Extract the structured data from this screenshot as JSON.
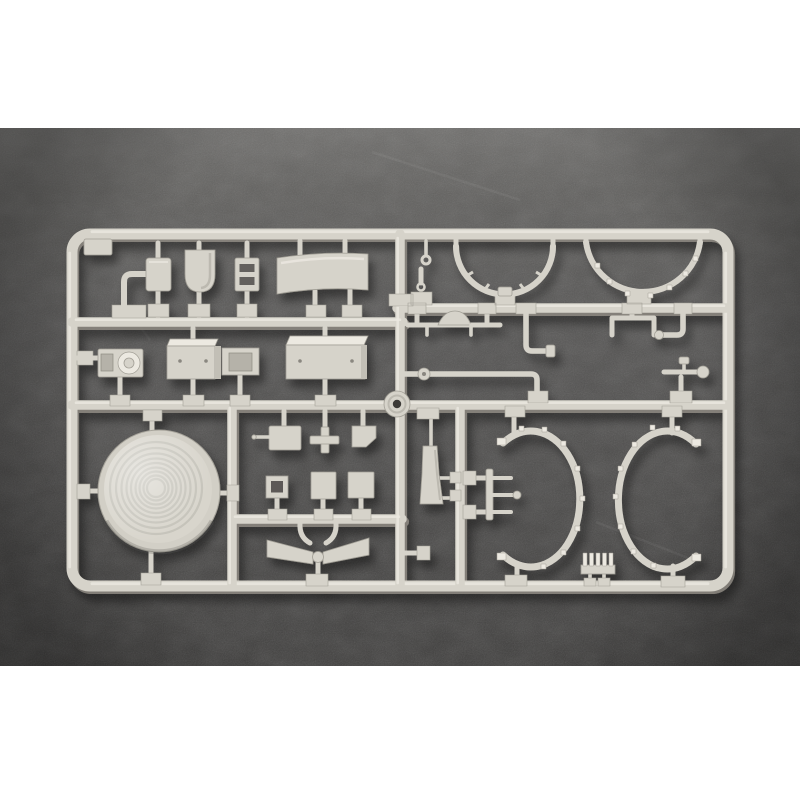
{
  "scene": {
    "kind": "photograph",
    "subject": "Injection-molded model kit sprue (light grey styrene parts tree) on a dark speckled surface",
    "description": "A rectangular light-grey plastic sprue frame holds unassembled scale-model parts: small fittings, a tank, a ladder bracket and a wide curved canvas panel in the top row; a winch and three riveted equipment boxes plus axles, elbow pipes and brackets in the middle row; a large ribbed circular dome, small hatches, bowtie wings, a rudder blade, a trident bracket, two open C-shaped half rings and a comb grate in the bottom row. The photo sits between plain white bands at the top and bottom of the image.",
    "visible_text": "",
    "part_count_approx": 40
  },
  "photo": {
    "band_top_px": 128,
    "band_bottom_px": 666,
    "surface": "dark grey speckled stone/felt, lighter toward the top, vignetted corners"
  },
  "colors": {
    "letterbox": "#ffffff",
    "bg_top": "#6f6e6c",
    "bg_mid": "#525150",
    "bg_bottom": "#3e3d3c",
    "plastic": "#d6d3ca",
    "plastic_light": "#ece9e1",
    "plastic_mid": "#c2bfb6",
    "plastic_dark": "#a29f96",
    "plastic_deep": "#8e8b82",
    "hole": "#3c3b38",
    "recess": "#b5b2a9",
    "rivet": "#8a8780"
  },
  "sprue": {
    "material": "light grey styrene",
    "frame": "rounded rectangle with two horizontal internal rails and three vertical rails",
    "parts": [
      {
        "name": "corner-tab",
        "desc": "small tab at top-left corner"
      },
      {
        "name": "hook-pipe",
        "desc": "candy-cane shaped pipe"
      },
      {
        "name": "small-box",
        "desc": "small rounded box"
      },
      {
        "name": "fuel-tank",
        "desc": "rounded-bottom tank"
      },
      {
        "name": "ladder-bracket",
        "desc": "plate with two slots"
      },
      {
        "name": "curved-panel",
        "desc": "wide slightly curved canvas panel"
      },
      {
        "name": "eyelet-pins",
        "desc": "two tiny pins with eye rings"
      },
      {
        "name": "tilt-frame-arc-left",
        "desc": "smooth semicircular bow"
      },
      {
        "name": "tilt-frame-arc-right",
        "desc": "studded semicircular bow"
      },
      {
        "name": "axle-with-hump",
        "desc": "rod with raised center"
      },
      {
        "name": "z-pipe",
        "desc": "down-and-right elbow pipe"
      },
      {
        "name": "staple-bracket",
        "desc": "U shaped bracket"
      },
      {
        "name": "elbow-pipe-ball",
        "desc": "elbow pipe with ball end"
      },
      {
        "name": "long-pipe-collar",
        "desc": "long pipe with collar and down elbow"
      },
      {
        "name": "lever-ball",
        "desc": "lever arm with ball end"
      },
      {
        "name": "winch",
        "desc": "box with round cable drum"
      },
      {
        "name": "equipment-box-1",
        "desc": "box with two rivets"
      },
      {
        "name": "equipment-box-2",
        "desc": "box with recessed door"
      },
      {
        "name": "equipment-box-3",
        "desc": "wide box with two rivets"
      },
      {
        "name": "grommet-ring",
        "desc": "small donut ring with center hole"
      },
      {
        "name": "ribbed-dome-disc",
        "desc": "large circular dome with concentric ribs"
      },
      {
        "name": "box-with-pin",
        "desc": "small box with side pin"
      },
      {
        "name": "cross-piece",
        "desc": "plus shaped fitting"
      },
      {
        "name": "angled-plate",
        "desc": "small notched plate"
      },
      {
        "name": "frame-square-open",
        "desc": "small open square frame"
      },
      {
        "name": "hatch-square-small",
        "desc": "small square hatch"
      },
      {
        "name": "hatch-square-large",
        "desc": "square hatch"
      },
      {
        "name": "bowtie-wings",
        "desc": "two outward wings meeting at a hub"
      },
      {
        "name": "rudder-blade",
        "desc": "tall tapered blade"
      },
      {
        "name": "trident-bracket",
        "desc": "bar with three prongs and ball tip"
      },
      {
        "name": "c-ring-left",
        "desc": "open ring, gap facing left, nubs outside"
      },
      {
        "name": "c-ring-right",
        "desc": "open ring, gap facing right, nubs outside"
      },
      {
        "name": "comb-grate",
        "desc": "small five-tooth grate"
      }
    ]
  }
}
